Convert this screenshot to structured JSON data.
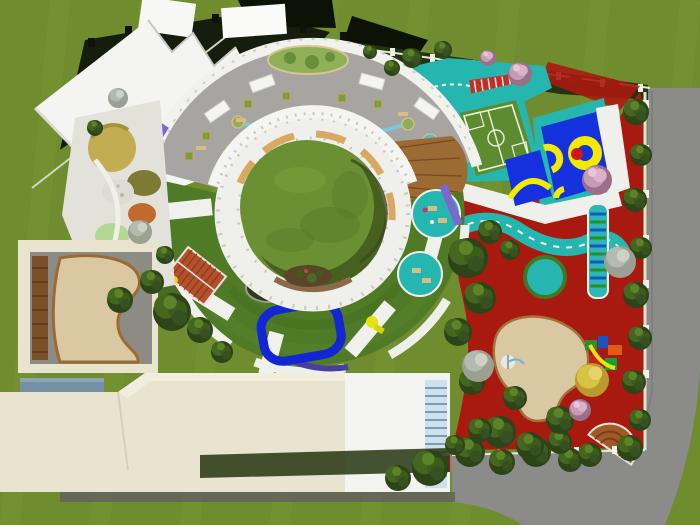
{
  "scene": {
    "type": "aerial-architectural-render",
    "subject": "top-down rendering of a kindergarten campus",
    "areas": {
      "central_courtyard": "circular grass courtyard inside ring building",
      "ring_building": "white circular building with green roof ring",
      "rooftop_terrace": "gray roof terrace with planters and water stream",
      "jagged_canopy": "white saw-tooth entrance canopy, north-west",
      "sensory_garden": "colored planting beds, west",
      "football_pitch": "mini football pitch on roof deck",
      "basketball_court": "blue basketball court with yellow markings",
      "red_playground": "red rubber playground with teal toddler road",
      "sand_pit": "sand play area among trees, south-east",
      "service_building": "cream flat-roof building, south-west",
      "perimeter_road": "gray road along east and south boundary"
    }
  },
  "colors": {
    "lawn": "#6f8c2f",
    "lawn_stripe": "#81a03c",
    "road": "#8b8b89",
    "road_shadow": "#63635d",
    "canopy_white": "#f4f4f2",
    "terrace_gray": "#a7a5a2",
    "building_white": "#efefec",
    "roof_ring_green": "#4f7a26",
    "courtyard_grass": "#6b9034",
    "courtyard_shade": "#47601f",
    "playground_red": "#a81a10",
    "play_teal": "#26b6b0",
    "court_blue": "#1530dd",
    "marking_yellow": "#f2ea00",
    "pitch_green": "#5d8b2f",
    "pool_blue": "#1226d6",
    "sand": "#d9c8a2",
    "deck_wood": "#9c6a33",
    "brick_red": "#b5502c",
    "violet": "#7b68cf",
    "water_blue": "#7cc6dd",
    "service_cream": "#e9e4cf",
    "planter_blue": "#7390a4",
    "hedge_dark": "#243312",
    "fence_white": "#e6ead9",
    "basket_red": "#cc1818",
    "tree_green": "#44661f",
    "tree_pink": "#dbb3c9",
    "tree_yellow": "#d8c343",
    "tree_gray": "#b5bab0"
  }
}
